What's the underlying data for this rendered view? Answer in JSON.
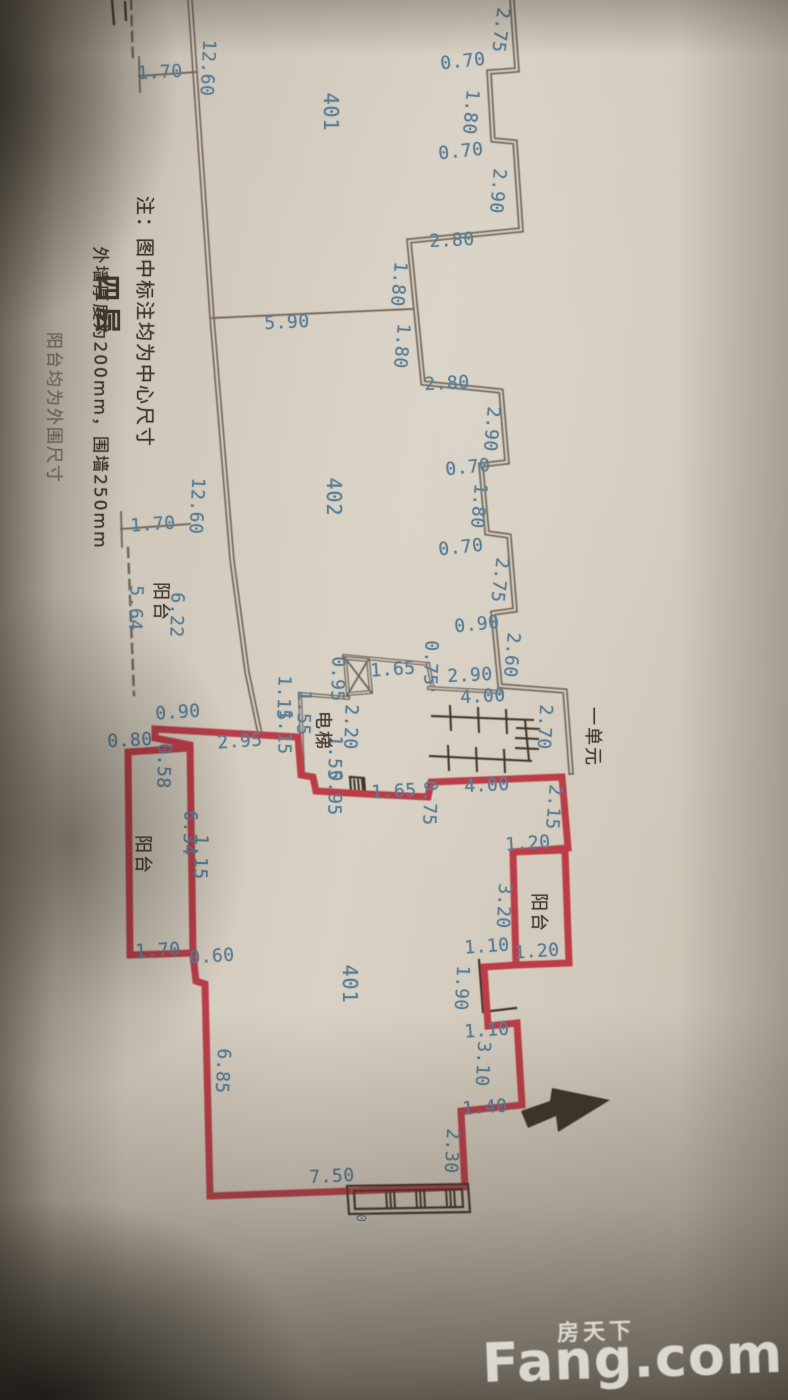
{
  "notes": {
    "line1": "注：图中标注均为中心尺寸",
    "line2": "外墙厚度为200mm，围墙250mm",
    "line3": "阳台均为外围尺寸",
    "floor_label": "四层"
  },
  "watermark": {
    "brand": "Fang.com",
    "brand_cn": "房天下"
  },
  "plan": {
    "colors": {
      "paper": "#d5cec0",
      "wall": "#6e6456",
      "red": "#bb3c46",
      "black": "#3a332a",
      "blue": "#5b7e97",
      "dark": "#463d32"
    },
    "walls": [
      {
        "style": "gray",
        "pts": [
          [
            190,
            0
          ],
          [
            212,
            318
          ],
          [
            232,
            560
          ],
          [
            247,
            672
          ],
          [
            260,
            734
          ]
        ]
      },
      {
        "style": "gray",
        "pts": [
          [
            512,
            0
          ],
          [
            517,
            70
          ],
          [
            489,
            72
          ],
          [
            493,
            140
          ],
          [
            515,
            142
          ],
          [
            521,
            230
          ],
          [
            409,
            241
          ],
          [
            416,
            312
          ],
          [
            423,
            383
          ],
          [
            501,
            391
          ],
          [
            507,
            462
          ],
          [
            481,
            465
          ],
          [
            487,
            533
          ],
          [
            509,
            536
          ],
          [
            515,
            610
          ],
          [
            493,
            613
          ],
          [
            500,
            686
          ],
          [
            565,
            691
          ],
          [
            571,
            772
          ]
        ]
      },
      {
        "style": "thin",
        "pts": [
          [
            212,
            318
          ],
          [
            412,
            309
          ]
        ]
      },
      {
        "style": "thin",
        "pts": [
          [
            139,
            57
          ],
          [
            140,
            92
          ]
        ]
      },
      {
        "style": "thin",
        "pts": [
          [
            139,
            76
          ],
          [
            197,
            72
          ]
        ]
      },
      {
        "style": "thin",
        "pts": [
          [
            121,
            512
          ],
          [
            122,
            547
          ]
        ]
      },
      {
        "style": "thin",
        "pts": [
          [
            121,
            529
          ],
          [
            190,
            524
          ]
        ]
      },
      {
        "style": "dash",
        "pts": [
          [
            131,
            0
          ],
          [
            133,
            62
          ]
        ]
      },
      {
        "style": "dash",
        "pts": [
          [
            128,
            548
          ],
          [
            134,
            695
          ]
        ]
      },
      {
        "style": "black",
        "pts": [
          [
            112,
            0
          ],
          [
            114,
            24
          ]
        ]
      },
      {
        "style": "black",
        "pts": [
          [
            125,
            2
          ],
          [
            126,
            20
          ]
        ]
      },
      {
        "style": "thin2",
        "pts": [
          [
            300,
            694
          ],
          [
            348,
            698
          ]
        ]
      },
      {
        "style": "thin2",
        "pts": [
          [
            300,
            694
          ],
          [
            303,
            773
          ]
        ]
      },
      {
        "style": "thin2",
        "pts": [
          [
            344,
            656
          ],
          [
            428,
            664
          ]
        ]
      },
      {
        "style": "thin2",
        "pts": [
          [
            428,
            664
          ],
          [
            433,
            689
          ]
        ]
      },
      {
        "style": "thin2",
        "pts": [
          [
            429,
            688
          ],
          [
            500,
            692
          ]
        ]
      },
      {
        "style": "thin2",
        "pts": [
          [
            345,
            658
          ],
          [
            368,
            660
          ],
          [
            371,
            692
          ],
          [
            348,
            694
          ],
          [
            345,
            658
          ]
        ]
      },
      {
        "style": "thin",
        "pts": [
          [
            345,
            658
          ],
          [
            371,
            692
          ]
        ]
      },
      {
        "style": "thin",
        "pts": [
          [
            368,
            660
          ],
          [
            348,
            694
          ]
        ]
      },
      {
        "style": "stair",
        "pts": [
          [
            432,
            716
          ],
          [
            533,
            720
          ]
        ]
      },
      {
        "style": "stair",
        "pts": [
          [
            430,
            756
          ],
          [
            531,
            761
          ]
        ]
      },
      {
        "style": "stair",
        "pts": [
          [
            525,
            720
          ],
          [
            529,
            760
          ]
        ]
      },
      {
        "style": "stair",
        "pts": [
          [
            450,
            706
          ],
          [
            451,
            730
          ]
        ]
      },
      {
        "style": "stair",
        "pts": [
          [
            478,
            708
          ],
          [
            479,
            732
          ]
        ]
      },
      {
        "style": "stair",
        "pts": [
          [
            506,
            710
          ],
          [
            507,
            733
          ]
        ]
      },
      {
        "style": "stair",
        "pts": [
          [
            448,
            746
          ],
          [
            449,
            770
          ]
        ]
      },
      {
        "style": "stair",
        "pts": [
          [
            476,
            748
          ],
          [
            477,
            771
          ]
        ]
      },
      {
        "style": "stair",
        "pts": [
          [
            504,
            750
          ],
          [
            505,
            772
          ]
        ]
      },
      {
        "style": "stair",
        "pts": [
          [
            517,
            728
          ],
          [
            539,
            729
          ]
        ]
      },
      {
        "style": "stair",
        "pts": [
          [
            516,
            738
          ],
          [
            538,
            739
          ]
        ]
      },
      {
        "style": "stair",
        "pts": [
          [
            516,
            748
          ],
          [
            538,
            749
          ]
        ]
      },
      {
        "style": "black",
        "pts": [
          [
            350,
            777
          ],
          [
            364,
            778
          ],
          [
            365,
            792
          ],
          [
            351,
            791
          ],
          [
            350,
            777
          ]
        ]
      },
      {
        "style": "stair",
        "pts": [
          [
            354,
            780
          ],
          [
            355,
            790
          ]
        ]
      },
      {
        "style": "stair",
        "pts": [
          [
            358,
            780
          ],
          [
            359,
            790
          ]
        ]
      },
      {
        "style": "stair",
        "pts": [
          [
            362,
            780
          ],
          [
            363,
            790
          ]
        ]
      },
      {
        "style": "black",
        "pts": [
          [
            479,
            960
          ],
          [
            483,
            1012
          ],
          [
            516,
            1008
          ]
        ]
      },
      {
        "style": "red",
        "pts": [
          [
            155,
            729
          ],
          [
            298,
            737
          ],
          [
            301,
            775
          ],
          [
            313,
            777
          ],
          [
            316,
            791
          ],
          [
            366,
            794
          ],
          [
            428,
            797
          ],
          [
            431,
            782
          ],
          [
            562,
            777
          ],
          [
            568,
            848
          ],
          [
            513,
            852
          ],
          [
            516,
            965
          ],
          [
            484,
            967
          ],
          [
            488,
            1026
          ],
          [
            517,
            1023
          ],
          [
            522,
            1105
          ],
          [
            461,
            1111
          ],
          [
            465,
            1187
          ],
          [
            210,
            1196
          ],
          [
            205,
            984
          ],
          [
            196,
            981
          ],
          [
            193,
            955
          ],
          [
            190,
            745
          ],
          [
            155,
            738
          ],
          [
            155,
            729
          ]
        ]
      },
      {
        "style": "red",
        "pts": [
          [
            513,
            852
          ],
          [
            565,
            850
          ],
          [
            569,
            963
          ],
          [
            516,
            965
          ]
        ]
      },
      {
        "style": "red",
        "pts": [
          [
            190,
            748
          ],
          [
            128,
            752
          ],
          [
            130,
            955
          ],
          [
            193,
            953
          ]
        ]
      },
      {
        "style": "black",
        "pts": [
          [
            347,
            1186
          ],
          [
            468,
            1184
          ],
          [
            470,
            1212
          ],
          [
            349,
            1214
          ],
          [
            347,
            1186
          ]
        ]
      },
      {
        "style": "black",
        "pts": [
          [
            354,
            1191
          ],
          [
            462,
            1189
          ],
          [
            463,
            1207
          ],
          [
            355,
            1209
          ],
          [
            354,
            1191
          ]
        ]
      },
      {
        "style": "stair",
        "pts": [
          [
            386,
            1191
          ],
          [
            387,
            1207
          ]
        ]
      },
      {
        "style": "stair",
        "pts": [
          [
            390,
            1191
          ],
          [
            391,
            1207
          ]
        ]
      },
      {
        "style": "stair",
        "pts": [
          [
            394,
            1191
          ],
          [
            395,
            1207
          ]
        ]
      },
      {
        "style": "stair",
        "pts": [
          [
            416,
            1190
          ],
          [
            417,
            1207
          ]
        ]
      },
      {
        "style": "stair",
        "pts": [
          [
            420,
            1190
          ],
          [
            421,
            1207
          ]
        ]
      },
      {
        "style": "stair",
        "pts": [
          [
            424,
            1190
          ],
          [
            425,
            1207
          ]
        ]
      },
      {
        "style": "stair",
        "pts": [
          [
            446,
            1189
          ],
          [
            447,
            1206
          ]
        ]
      },
      {
        "style": "stair",
        "pts": [
          [
            450,
            1189
          ],
          [
            451,
            1206
          ]
        ]
      },
      {
        "style": "stair",
        "pts": [
          [
            454,
            1189
          ],
          [
            455,
            1206
          ]
        ]
      }
    ],
    "arrow": [
      [
        552,
        1088
      ],
      [
        610,
        1100
      ],
      [
        558,
        1132
      ],
      [
        556,
        1116
      ],
      [
        528,
        1128
      ],
      [
        521,
        1111
      ],
      [
        550,
        1101
      ]
    ],
    "labels": [
      [
        "1.70",
        160,
        73,
        -3,
        "d"
      ],
      [
        "12.60",
        207,
        68,
        93,
        "d"
      ],
      [
        "401",
        331,
        112,
        90,
        "r"
      ],
      [
        "2.75",
        500,
        30,
        97,
        "d"
      ],
      [
        "0.70",
        463,
        62,
        -6,
        "d"
      ],
      [
        "1.80",
        470,
        112,
        95,
        "d"
      ],
      [
        "0.70",
        461,
        152,
        -6,
        "d"
      ],
      [
        "2.90",
        497,
        191,
        95,
        "d"
      ],
      [
        "2.80",
        452,
        241,
        -3,
        "d"
      ],
      [
        "1.80",
        398,
        284,
        95,
        "d"
      ],
      [
        "5.90",
        287,
        323,
        -3,
        "d"
      ],
      [
        "1.80",
        401,
        346,
        95,
        "d"
      ],
      [
        "2.80",
        447,
        384,
        -3,
        "d"
      ],
      [
        "2.90",
        491,
        429,
        95,
        "d"
      ],
      [
        "0.70",
        468,
        468,
        -6,
        "d"
      ],
      [
        "1.80",
        478,
        506,
        95,
        "d"
      ],
      [
        "0.70",
        461,
        548,
        -6,
        "d"
      ],
      [
        "2.75",
        499,
        580,
        97,
        "d"
      ],
      [
        "0.90",
        477,
        625,
        -6,
        "d"
      ],
      [
        "2.60",
        511,
        655,
        95,
        "d"
      ],
      [
        "402",
        334,
        497,
        90,
        "r"
      ],
      [
        "12.60",
        196,
        506,
        93,
        "d"
      ],
      [
        "1.70",
        153,
        525,
        -4,
        "d"
      ],
      [
        "5.64",
        135,
        608,
        92,
        "d"
      ],
      [
        "阳台",
        160,
        602,
        90,
        "k"
      ],
      [
        "6.22",
        176,
        615,
        92,
        "d"
      ],
      [
        "0.90",
        178,
        713,
        -4,
        "d"
      ],
      [
        "0.80",
        130,
        741,
        -3,
        "d"
      ],
      [
        "2.95",
        240,
        742,
        -4,
        "d"
      ],
      [
        "0.58",
        163,
        766,
        92,
        "d"
      ],
      [
        "1.15",
        283,
        698,
        92,
        "d"
      ],
      [
        "1.15",
        284,
        732,
        92,
        "d"
      ],
      [
        "1.55",
        303,
        713,
        92,
        "d"
      ],
      [
        "2.20",
        350,
        727,
        92,
        "d"
      ],
      [
        "1.55",
        334,
        758,
        92,
        "d"
      ],
      [
        "电梯",
        322,
        731,
        90,
        "k"
      ],
      [
        "0.95",
        337,
        679,
        92,
        "d"
      ],
      [
        "1.65",
        393,
        670,
        -4,
        "d"
      ],
      [
        "0.75",
        430,
        663,
        92,
        "d"
      ],
      [
        "2.90",
        470,
        676,
        -3,
        "d"
      ],
      [
        "4.00",
        483,
        697,
        -3,
        "d"
      ],
      [
        "2.70",
        544,
        727,
        93,
        "d"
      ],
      [
        "一单元",
        592,
        737,
        90,
        "k"
      ],
      [
        "0.95",
        334,
        793,
        92,
        "d"
      ],
      [
        "1.65",
        394,
        792,
        -3,
        "d"
      ],
      [
        "0.75",
        429,
        803,
        92,
        "d"
      ],
      [
        "4.00",
        487,
        786,
        -3,
        "d"
      ],
      [
        "2.15",
        553,
        807,
        95,
        "d"
      ],
      [
        "1.20",
        528,
        844,
        -4,
        "d"
      ],
      [
        "阳台",
        538,
        913,
        90,
        "k"
      ],
      [
        "3.20",
        503,
        906,
        93,
        "d"
      ],
      [
        "1.10",
        487,
        947,
        -4,
        "d"
      ],
      [
        "1.20",
        537,
        952,
        -4,
        "d"
      ],
      [
        "1.90",
        461,
        988,
        93,
        "d"
      ],
      [
        "1.10",
        487,
        1031,
        -4,
        "d"
      ],
      [
        "3.10",
        482,
        1064,
        93,
        "d"
      ],
      [
        "1.40",
        485,
        1108,
        -4,
        "d"
      ],
      [
        "2.30",
        451,
        1151,
        93,
        "d"
      ],
      [
        "401",
        350,
        984,
        90,
        "r"
      ],
      [
        "阳台",
        142,
        855,
        90,
        "k"
      ],
      [
        "6.34",
        189,
        833,
        92,
        "d"
      ],
      [
        "1.15",
        200,
        857,
        92,
        "d"
      ],
      [
        "1.70",
        158,
        951,
        -3,
        "d"
      ],
      [
        "0.60",
        212,
        957,
        -4,
        "d"
      ],
      [
        "6.85",
        222,
        1071,
        93,
        "d"
      ],
      [
        "7.50",
        332,
        1177,
        -3,
        "d"
      ],
      [
        "0",
        360,
        1218,
        90,
        "s"
      ]
    ]
  }
}
